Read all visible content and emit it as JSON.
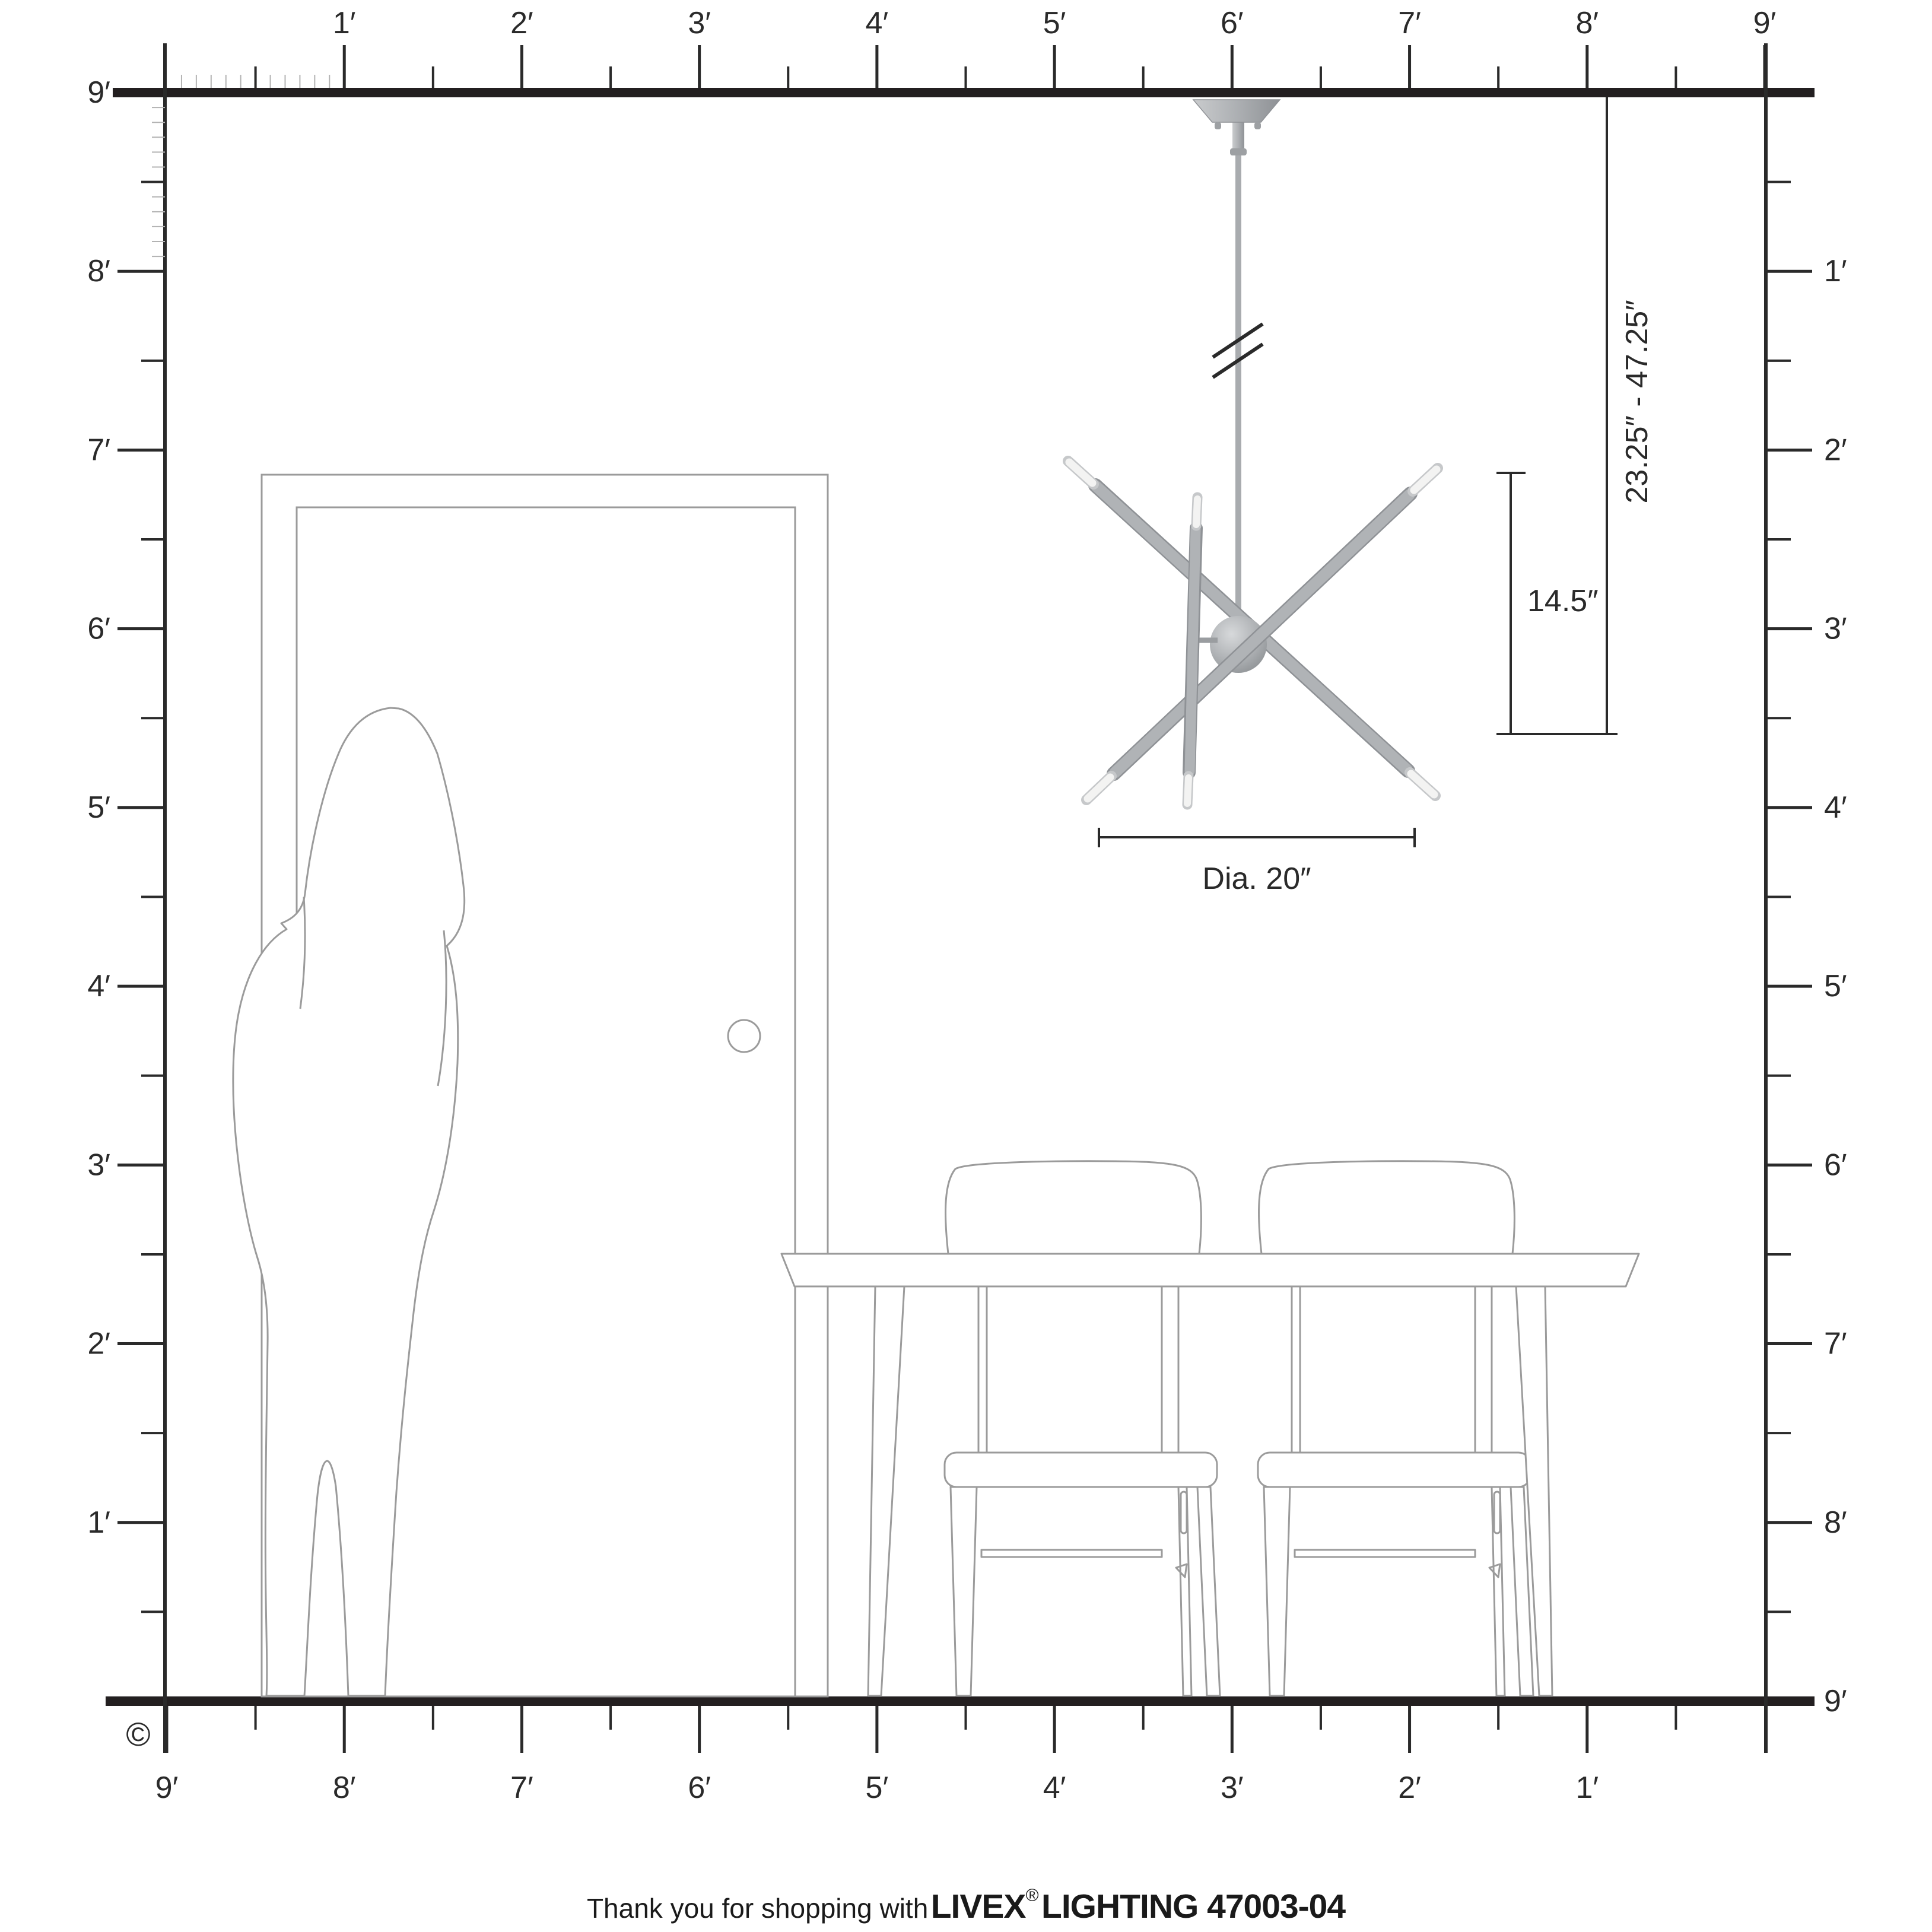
{
  "footer": {
    "prefix": "Thank you for shopping with",
    "brand": "LIVEX",
    "registered": "®",
    "suffix": "LIGHTING 47003-04"
  },
  "copyright_symbol": "©",
  "annotations": {
    "suspension_range": "23.25″ - 47.25″",
    "body_height": "14.5″",
    "diameter": "Dia. 20″"
  },
  "rulers": {
    "unit": "feet",
    "top_labels": [
      "1′",
      "2′",
      "3′",
      "4′",
      "5′",
      "6′",
      "7′",
      "8′",
      "9′"
    ],
    "bottom_labels": [
      "9′",
      "8′",
      "7′",
      "6′",
      "5′",
      "4′",
      "3′",
      "2′",
      "1′"
    ],
    "left_labels": [
      "9′",
      "8′",
      "7′",
      "6′",
      "5′",
      "4′",
      "3′",
      "2′",
      "1′"
    ],
    "right_labels": [
      "1′",
      "2′",
      "3′",
      "4′",
      "5′",
      "6′",
      "7′",
      "8′",
      "9′"
    ]
  },
  "colors": {
    "ink": "#2a2a2a",
    "bar": "#231f20",
    "outline_gray": "#9b9b9b",
    "inch_tick_gray": "#b3b3b3",
    "metal": "#b0b3b6",
    "metal_dark": "#8f9296",
    "metal_light": "#d6d8da",
    "bulb": "#f3f3f2"
  }
}
